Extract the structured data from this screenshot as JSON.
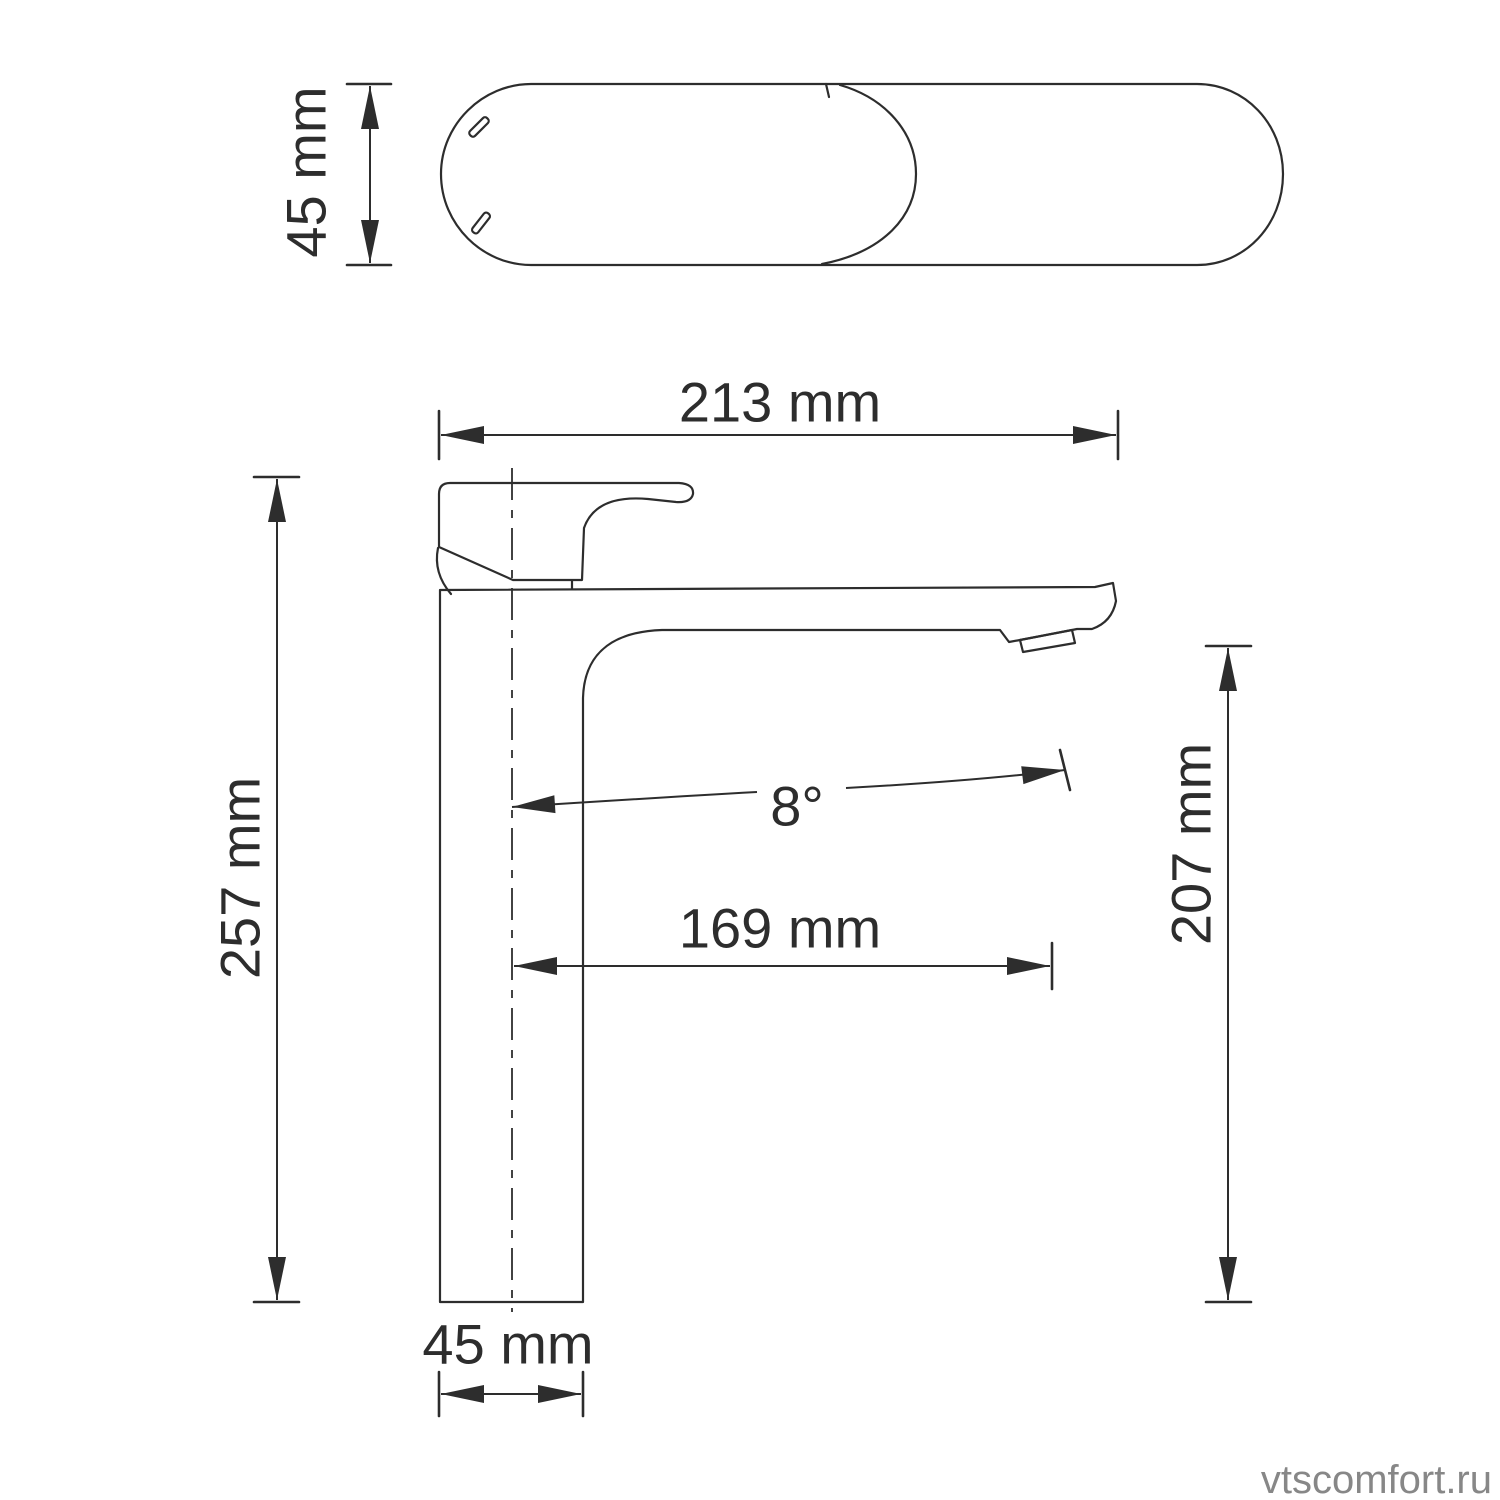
{
  "colors": {
    "background": "#ffffff",
    "line": "#2d2d2d",
    "watermark": "#878787"
  },
  "drawing": {
    "subject": "single-lever basin faucet technical drawing",
    "views": {
      "top_view": "faucet top view (spout and handle footprint)",
      "side_view": "faucet side view with dimension callouts"
    }
  },
  "dimensions": {
    "top_view_width": "45 mm",
    "overall_length": "213 mm",
    "overall_height": "257 mm",
    "spout_reach": "169 mm",
    "spout_height": "207 mm",
    "spout_angle": "8°",
    "base_width": "45 mm"
  },
  "watermark": "vtscomfort.ru"
}
